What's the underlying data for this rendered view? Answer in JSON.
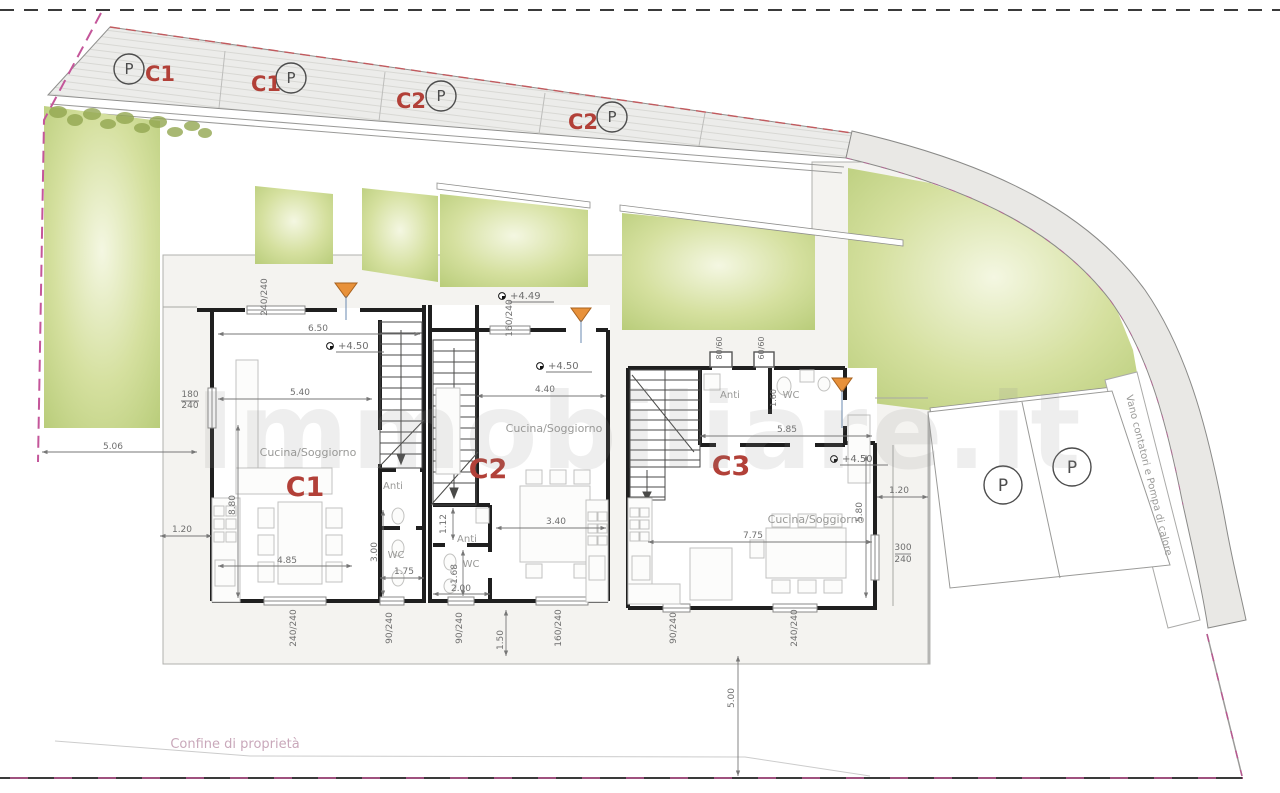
{
  "site": {
    "type": "architectural-site-plan",
    "colors": {
      "unit_label_red": "#b24038",
      "garden_green": "#cdd996",
      "road_gray": "#e9e8e5",
      "boundary_magenta": "#c4569a",
      "entrance_arrow_orange": "#e8913a"
    },
    "units": [
      "C1",
      "C2",
      "C3"
    ],
    "parking_top_stalls": [
      "C1",
      "C1",
      "C2",
      "C2"
    ],
    "parking_right_stalls": [
      "P",
      "P"
    ]
  },
  "labels": [
    {
      "name": "parking-stall-1-p",
      "text": "P",
      "x": 129,
      "y": 74,
      "size": 15,
      "cls": "t-p"
    },
    {
      "name": "parking-stall-1-unit",
      "text": "C1",
      "x": 160,
      "y": 81,
      "size": 21,
      "cls": "t-red"
    },
    {
      "name": "parking-stall-2-unit",
      "text": "C1",
      "x": 266,
      "y": 91,
      "size": 21,
      "cls": "t-red"
    },
    {
      "name": "parking-stall-2-p",
      "text": "P",
      "x": 291,
      "y": 83,
      "size": 15,
      "cls": "t-p"
    },
    {
      "name": "parking-stall-3-unit",
      "text": "C2",
      "x": 411,
      "y": 108,
      "size": 21,
      "cls": "t-red"
    },
    {
      "name": "parking-stall-3-p",
      "text": "P",
      "x": 441,
      "y": 101,
      "size": 15,
      "cls": "t-p"
    },
    {
      "name": "parking-stall-4-unit",
      "text": "C2",
      "x": 583,
      "y": 129,
      "size": 21,
      "cls": "t-red"
    },
    {
      "name": "parking-stall-4-p",
      "text": "P",
      "x": 612,
      "y": 122,
      "size": 15,
      "cls": "t-p"
    },
    {
      "name": "parking-right-1-p",
      "text": "P",
      "x": 1003,
      "y": 491,
      "size": 17,
      "cls": "t-p"
    },
    {
      "name": "parking-right-2-p",
      "text": "P",
      "x": 1072,
      "y": 473,
      "size": 17,
      "cls": "t-p"
    },
    {
      "name": "unit-label-c1",
      "text": "C1",
      "x": 305,
      "y": 496,
      "size": 27,
      "cls": "t-red"
    },
    {
      "name": "unit-label-c2",
      "text": "C2",
      "x": 488,
      "y": 478,
      "size": 27,
      "cls": "t-red"
    },
    {
      "name": "unit-label-c3",
      "text": "C3",
      "x": 731,
      "y": 475,
      "size": 27,
      "cls": "t-red"
    },
    {
      "name": "room-label-c1-living",
      "text": "Cucina/Soggiorno",
      "x": 308,
      "y": 456,
      "size": 11,
      "cls": "t-room"
    },
    {
      "name": "room-label-c2-living",
      "text": "Cucina/Soggiorno",
      "x": 554,
      "y": 432,
      "size": 11,
      "cls": "t-room"
    },
    {
      "name": "room-label-c3-living",
      "text": "Cucina/Soggiorno",
      "x": 816,
      "y": 523,
      "size": 11,
      "cls": "t-room"
    },
    {
      "name": "room-label-c1-anti",
      "text": "Anti",
      "x": 393,
      "y": 489,
      "size": 10,
      "cls": "t-room"
    },
    {
      "name": "room-label-c1-wc",
      "text": "WC",
      "x": 396,
      "y": 558,
      "size": 10,
      "cls": "t-room"
    },
    {
      "name": "room-label-c2-anti",
      "text": "Anti",
      "x": 467,
      "y": 542,
      "size": 10,
      "cls": "t-room"
    },
    {
      "name": "room-label-c2-wc",
      "text": "WC",
      "x": 471,
      "y": 567,
      "size": 10,
      "cls": "t-room"
    },
    {
      "name": "room-label-c3-anti",
      "text": "Anti",
      "x": 730,
      "y": 398,
      "size": 10,
      "cls": "t-room"
    },
    {
      "name": "room-label-c3-wc",
      "text": "WC",
      "x": 791,
      "y": 398,
      "size": 10,
      "cls": "t-room"
    },
    {
      "name": "level-c1",
      "text": "+4.50",
      "x": 338,
      "y": 349,
      "size": 10,
      "cls": "t-dim",
      "anchor": "start"
    },
    {
      "name": "level-c2-terrace",
      "text": "+4.49",
      "x": 510,
      "y": 299,
      "size": 10,
      "cls": "t-dim",
      "anchor": "start"
    },
    {
      "name": "level-c2",
      "text": "+4.50",
      "x": 548,
      "y": 369,
      "size": 10,
      "cls": "t-dim",
      "anchor": "start"
    },
    {
      "name": "level-c3",
      "text": "+4.50",
      "x": 842,
      "y": 462,
      "size": 10,
      "cls": "t-dim",
      "anchor": "start"
    },
    {
      "name": "dim-c1-width",
      "text": "6.50",
      "x": 318,
      "y": 331,
      "size": 9,
      "cls": "t-dim"
    },
    {
      "name": "dim-c1-540",
      "text": "5.40",
      "x": 300,
      "y": 395,
      "size": 9,
      "cls": "t-dim"
    },
    {
      "name": "dim-c1-485",
      "text": "4.85",
      "x": 287,
      "y": 563,
      "size": 9,
      "cls": "t-dim"
    },
    {
      "name": "dim-c1-880",
      "text": "8.80",
      "x": 235,
      "y": 505,
      "size": 9,
      "cls": "t-dim",
      "rot": -90
    },
    {
      "name": "dim-win-c1-left-num",
      "text": "180",
      "x": 190,
      "y": 397,
      "size": 9,
      "cls": "t-dim"
    },
    {
      "name": "dim-win-c1-left-den",
      "text": "240",
      "x": 190,
      "y": 408,
      "size": 9,
      "cls": "t-dim"
    },
    {
      "name": "dim-win-c1-top",
      "text": "240/240",
      "x": 267,
      "y": 297,
      "size": 9,
      "cls": "t-dim",
      "rot": -90
    },
    {
      "name": "dim-win-c2-top",
      "text": "160/240",
      "x": 512,
      "y": 318,
      "size": 9,
      "cls": "t-dim",
      "rot": -90
    },
    {
      "name": "dim-c2-440",
      "text": "4.40",
      "x": 545,
      "y": 392,
      "size": 9,
      "cls": "t-dim"
    },
    {
      "name": "dim-c2-340",
      "text": "3.40",
      "x": 556,
      "y": 524,
      "size": 9,
      "cls": "t-dim"
    },
    {
      "name": "dim-c2-112",
      "text": "1.12",
      "x": 446,
      "y": 524,
      "size": 9,
      "cls": "t-dim",
      "rot": -90
    },
    {
      "name": "dim-c2-168",
      "text": "1.68",
      "x": 457,
      "y": 574,
      "size": 9,
      "cls": "t-dim",
      "rot": -90
    },
    {
      "name": "dim-c2-200",
      "text": "2.00",
      "x": 461,
      "y": 591,
      "size": 9,
      "cls": "t-dim"
    },
    {
      "name": "dim-c1-300",
      "text": "3.00",
      "x": 377,
      "y": 552,
      "size": 9,
      "cls": "t-dim",
      "rot": -90
    },
    {
      "name": "dim-c1-175",
      "text": "1.75",
      "x": 404,
      "y": 574,
      "size": 9,
      "cls": "t-dim"
    },
    {
      "name": "dim-left-120",
      "text": "1.20",
      "x": 182,
      "y": 532,
      "size": 9,
      "cls": "t-dim"
    },
    {
      "name": "dim-left-506",
      "text": "5.06",
      "x": 113,
      "y": 449,
      "size": 9,
      "cls": "t-dim"
    },
    {
      "name": "dim-win-c1-b1",
      "text": "240/240",
      "x": 296,
      "y": 628,
      "size": 9,
      "cls": "t-dim",
      "rot": -90
    },
    {
      "name": "dim-win-c1-b2",
      "text": "90/240",
      "x": 392,
      "y": 628,
      "size": 9,
      "cls": "t-dim",
      "rot": -90
    },
    {
      "name": "dim-win-c2-b1",
      "text": "90/240",
      "x": 462,
      "y": 628,
      "size": 9,
      "cls": "t-dim",
      "rot": -90
    },
    {
      "name": "dim-win-c2-b2",
      "text": "160/240",
      "x": 561,
      "y": 628,
      "size": 9,
      "cls": "t-dim",
      "rot": -90
    },
    {
      "name": "dim-c2-150",
      "text": "1.50",
      "x": 503,
      "y": 640,
      "size": 9,
      "cls": "t-dim",
      "rot": -90
    },
    {
      "name": "dim-win-c3-b1",
      "text": "90/240",
      "x": 676,
      "y": 628,
      "size": 9,
      "cls": "t-dim",
      "rot": -90
    },
    {
      "name": "dim-win-c3-b2",
      "text": "240/240",
      "x": 797,
      "y": 628,
      "size": 9,
      "cls": "t-dim",
      "rot": -90
    },
    {
      "name": "dim-vent-c3-1",
      "text": "80/60",
      "x": 722,
      "y": 348,
      "size": 8,
      "cls": "t-dim",
      "rot": -90
    },
    {
      "name": "dim-vent-c3-2",
      "text": "60/60",
      "x": 764,
      "y": 348,
      "size": 8,
      "cls": "t-dim",
      "rot": -90
    },
    {
      "name": "dim-c3-wc-160",
      "text": "1.60",
      "x": 776,
      "y": 398,
      "size": 8,
      "cls": "t-dim",
      "rot": -90
    },
    {
      "name": "dim-c3-585",
      "text": "5.85",
      "x": 787,
      "y": 432,
      "size": 9,
      "cls": "t-dim"
    },
    {
      "name": "dim-c3-775",
      "text": "7.75",
      "x": 753,
      "y": 538,
      "size": 9,
      "cls": "t-dim"
    },
    {
      "name": "dim-c3-580",
      "text": "5.80",
      "x": 862,
      "y": 512,
      "size": 9,
      "cls": "t-dim",
      "rot": -90
    },
    {
      "name": "dim-win-c3-right-num",
      "text": "300",
      "x": 903,
      "y": 550,
      "size": 9,
      "cls": "t-dim"
    },
    {
      "name": "dim-win-c3-right-den",
      "text": "240",
      "x": 903,
      "y": 562,
      "size": 9,
      "cls": "t-dim"
    },
    {
      "name": "dim-right-120",
      "text": "1.20",
      "x": 899,
      "y": 493,
      "size": 9,
      "cls": "t-dim"
    },
    {
      "name": "dim-south-500",
      "text": "5.00",
      "x": 734,
      "y": 698,
      "size": 9,
      "cls": "t-dim",
      "rot": -90
    },
    {
      "name": "utility-strip-label",
      "text": "Vano contatori e Pompa di calore",
      "x": 1146,
      "y": 476,
      "size": 10,
      "cls": "t-room",
      "rot": 76
    },
    {
      "name": "property-boundary-label",
      "text": "Confine di proprietà",
      "x": 235,
      "y": 748,
      "size": 13,
      "cls": "t-pink"
    },
    {
      "name": "watermark",
      "text": "Immobiliare.it",
      "x": 640,
      "y": 468,
      "size": 105,
      "cls": "t-wm"
    }
  ]
}
